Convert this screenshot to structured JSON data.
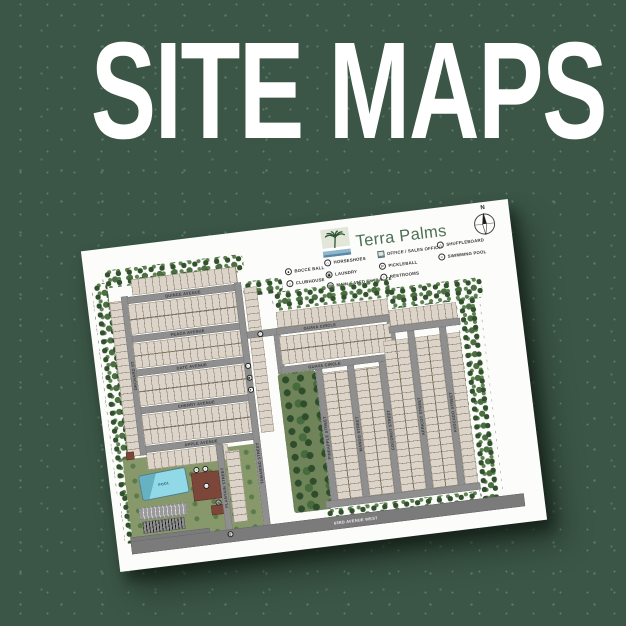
{
  "heading": "SITE MAPS",
  "map": {
    "community_name": "Terra Palms",
    "compass_label": "N",
    "legend": {
      "columns": [
        {
          "items": [
            {
              "name": "bocce-ball",
              "glyph": "●",
              "label": "BOCCE BALL"
            },
            {
              "name": "clubhouse",
              "glyph": "⌂",
              "label": "CLUBHOUSE"
            }
          ]
        },
        {
          "items": [
            {
              "name": "horseshoes",
              "glyph": "∩",
              "label": "HORSESHOES"
            },
            {
              "name": "laundry",
              "glyph": "▣",
              "label": "LAUNDRY"
            },
            {
              "name": "main-gated-entrance",
              "glyph": "▥",
              "label": "MAIN GATED ENTRANCE"
            }
          ]
        },
        {
          "items": [
            {
              "name": "office-sales-office",
              "glyph": "",
              "label": "OFFICE / SALES OFFICE"
            },
            {
              "name": "pickleball",
              "glyph": "P",
              "label": "PICKLEBALL"
            },
            {
              "name": "restrooms",
              "glyph": "♀",
              "label": "RESTROOMS"
            }
          ]
        },
        {
          "items": [
            {
              "name": "shuffleboard",
              "glyph": "△",
              "label": "SHUFFLEBOARD"
            },
            {
              "name": "swimming-pool",
              "glyph": "≈",
              "label": "SWIMMING POOL"
            }
          ]
        }
      ]
    },
    "streets": {
      "horizontal": [
        "QUINCE AVENUE",
        "PEACH AVENUE",
        "DATE AVENUE",
        "CHERRY AVENUE",
        "APPLE AVENUE"
      ],
      "vertical": [
        "ORCHARD ST",
        "TAMARIND STREET",
        "PLANTAIN STREET",
        "PINEAPPLE STREET",
        "MANGO STREET",
        "COCONUT STREET",
        "APRICOT STREET",
        "AVOCADO STREET"
      ],
      "circle_top": "GUAVA CIRCLE",
      "circle_bottom": "GUAVA CIRCLE",
      "boundary_road": "63RD AVENUE WEST"
    },
    "amenity_labels": {
      "pool": "POOL"
    },
    "markers": [
      {
        "name": "shuffleboard-marker",
        "glyph": "△"
      },
      {
        "name": "horseshoes-marker",
        "glyph": "∩"
      },
      {
        "name": "laundry-marker",
        "glyph": "▣"
      },
      {
        "name": "bocce-marker",
        "glyph": "●"
      },
      {
        "name": "pool-marker",
        "glyph": "≈"
      },
      {
        "name": "restrooms-marker",
        "glyph": "♀"
      },
      {
        "name": "clubhouse-marker",
        "glyph": "⌂"
      },
      {
        "name": "office-marker",
        "glyph": "▦"
      },
      {
        "name": "gate-marker",
        "glyph": "▥"
      }
    ]
  },
  "colors": {
    "background": "#3b5646",
    "heading_text": "#ffffff",
    "title_green": "#4d7054",
    "road_gray": "#8f8f8f",
    "lot_tan": "#dcd4c8",
    "tree_green": "#33512f",
    "lawn_green": "#87996a",
    "pool_blue": "#92d9e7",
    "building_brown": "#7c4739"
  }
}
